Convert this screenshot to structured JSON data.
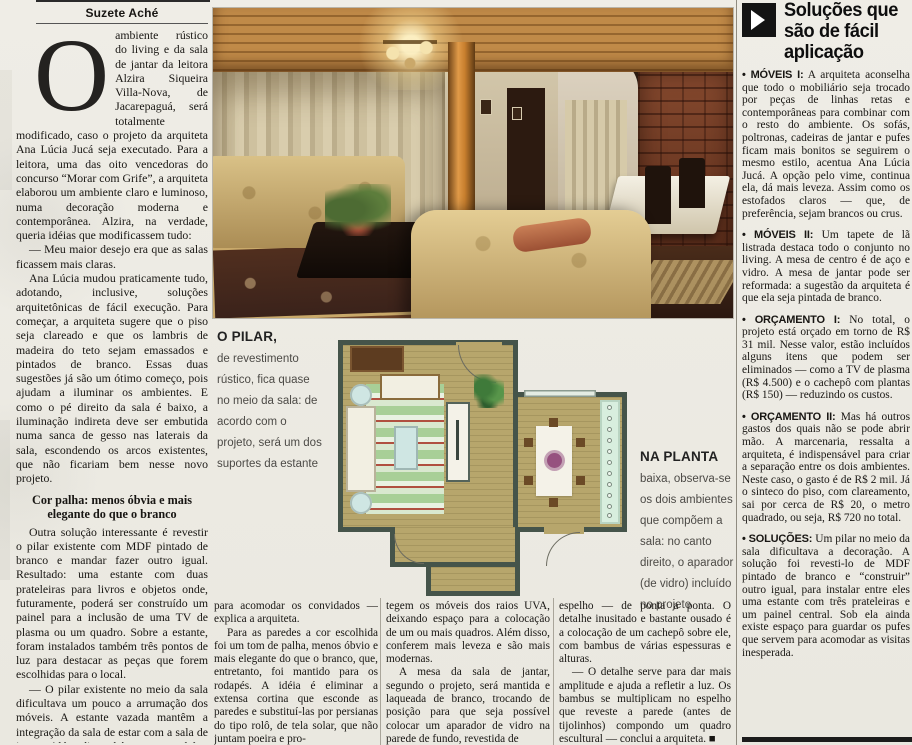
{
  "byline": "Suzete Aché",
  "article": {
    "dropcap": "O",
    "lead_rest": "ambiente rústico do living e da sala de jantar da leitora Alzira Siqueira Villa-Nova, de Jacarepaguá, será totalmente modificado, caso o projeto da arquiteta Ana Lúcia Jucá seja executado. Para a leitora, uma das oito vencedoras do concurso “Morar com Grife”, a arquiteta elaborou um ambiente claro e luminoso, numa decoração moderna e contemporânea. Alzira, na verdade, queria idéias que modificassem tudo:",
    "quote1": "— Meu maior desejo era que as salas ficassem mais claras.",
    "p2": "Ana Lúcia mudou praticamente tudo, adotando, inclusive, soluções arquitetônicas de fácil execução. Para começar, a arquiteta sugere que o piso seja clareado e que os lambris de madeira do teto sejam emassados e pintados de branco. Essas duas sugestões já são um ótimo começo, pois ajudam a iluminar os ambientes. E como o pé direito da sala é baixo, a iluminação indireta deve ser embutida numa sanca de gesso nas laterais da sala, escondendo os arcos existentes, que não ficariam bem nesse novo projeto.",
    "subhead": "Cor palha: menos óbvia e mais elegante do que o branco",
    "p3": "Outra solução interessante é revestir o pilar existente com MDF pintado de branco e mandar fazer outro igual. Resultado: uma estante com duas prateleiras para livros e objetos onde, futuramente, poderá ser construído um painel para a inclusão de uma TV de plasma ou um quadro. Sobre a estante, foram instalados também três pontos de luz para destacar as peças que forem escolhidas para o local.",
    "p4": "— O pilar existente no meio da sala dificultava um pouco a arrumação dos móveis. A estante vazada mantêm a integração da sala de estar com a sala de jantar. Além disso, há espaço também, sob a estante, para três pufes. Eles dão uma certa flexibilidade",
    "col2_p1": "para acomodar os convidados — explica a arquiteta.",
    "col2_p2": "Para as paredes a cor escolhida foi um tom de palha, menos óbvio e mais elegante do que o branco, que, entretanto, foi mantido para os rodapés. A idéia é eliminar a extensa cortina que esconde as paredes e substituí-las por persianas do tipo rolô, de tela solar, que não juntam poeira e pro-",
    "col3_p1": "tegem os móveis dos raios UVA, deixando espaço para a colocação de um ou mais quadros. Além disso, conferem mais leveza e são mais modernas.",
    "col3_p2": "A mesa da sala de jantar, segundo o projeto, será mantida e laqueada de branco, trocando de posição para que seja possível colocar um aparador de vidro na parede de fundo, revestida de",
    "col4_p1": "espelho — de ponta a ponta. O detalhe inusitado e bastante ousado é a colocação de um cachepô sobre ele, com bambus de várias espessuras e alturas.",
    "col4_p2": "— O detalhe serve para dar mais amplitude e ajuda a refletir a luz. Os bambus se multiplicam no espelho que reveste a parede (antes de tijolinhos) compondo um quadro escultural — conclui a arquiteta. ■"
  },
  "captions": {
    "pilar_title": "O PILAR,",
    "pilar_body": "de revestimento rústico, fica quase no meio da sala: de acordo com o projeto, será um dos suportes da estante",
    "planta_title": "NA PLANTA",
    "planta_body": "baixa, observa-se os dois ambientes que compõem a sala: no canto direito, o aparador (de vidro) incluído no projeto"
  },
  "sidebar": {
    "title": "Soluções que são de fácil aplicação",
    "arrow_icon": "play-triangle",
    "items": [
      {
        "label": "• MÓVEIS I:",
        "text": "A arquiteta aconselha que todo o mobiliário seja trocado por peças de linhas retas e contemporâneas para combinar com o resto do ambiente. Os sofás, poltronas, cadeiras de jantar e pufes ficam mais bonitos se seguirem o mesmo estilo, acentua Ana Lúcia Jucá. A opção pelo vime, continua ela, dá mais leveza. Assim como os estofados claros — que, de preferência, sejam brancos ou crus."
      },
      {
        "label": "• MÓVEIS II:",
        "text": "Um tapete de lã listrada destaca todo o conjunto no living. A mesa de centro é de aço e vidro. A mesa de jantar pode ser reformada: a sugestão da arquiteta é que ela seja pintada de branco."
      },
      {
        "label": "• ORÇAMENTO I:",
        "text": "No total, o projeto está orçado em torno de R$ 31 mil. Nesse valor, estão incluídos alguns itens que podem ser eliminados — como a TV de plasma (R$ 4.500) e o cachepô com plantas (R$ 150) — reduzindo os custos."
      },
      {
        "label": "• ORÇAMENTO II:",
        "text": "Mas há outros gastos dos quais não se pode abrir mão. A marcenaria, ressalta a arquiteta, é indispensável para criar a separação entre os dois ambientes. Neste caso, o gasto é de R$ 2 mil. Já o sinteco do piso, com clareamento, sai por cerca de R$ 20, o metro quadrado, ou seja, R$ 720 no total."
      },
      {
        "label": "• SOLUÇÕES:",
        "text": "Um pilar no meio da sala dificultava a decoração. A solução foi revesti-lo de MDF pintado de branco e “construir” outro igual, para instalar entre eles uma estante com três prateleiras e um painel central. Sob ela ainda existe espaço para guardar os pufes que servem para acomodar as visitas inesperada."
      }
    ]
  },
  "colors": {
    "plan_floor": "#b7a66c",
    "plan_wall": "#45544a",
    "plan_rug_green": "#a8cf97",
    "plan_glass": "#cfe6e3",
    "plan_accent_purple": "#96517f",
    "photo_wood": "#c08a48",
    "photo_brick": "#8a4c30",
    "newsprint": "#edebe4"
  }
}
